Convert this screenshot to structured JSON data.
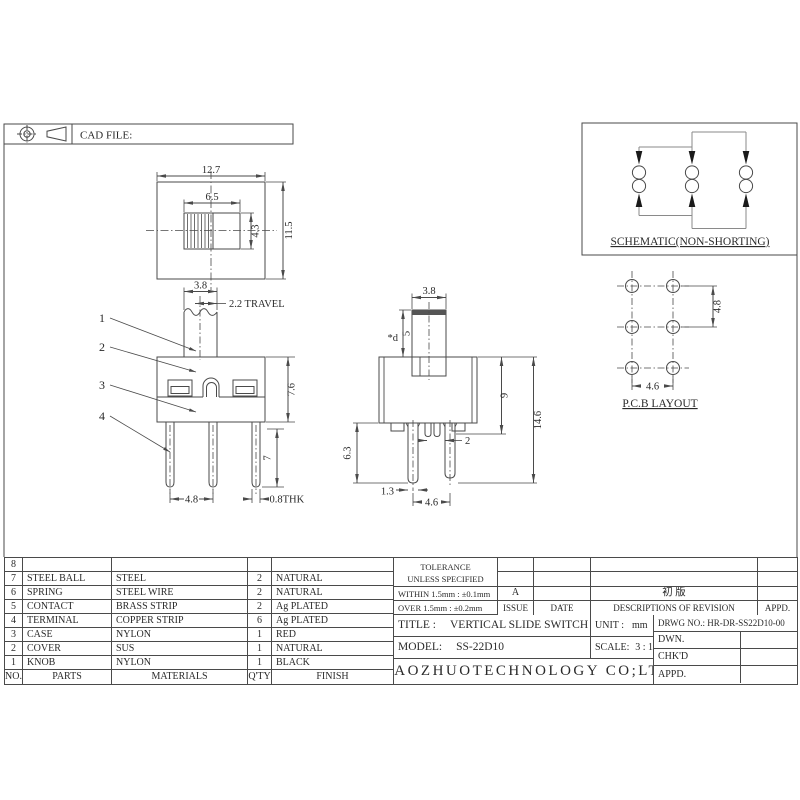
{
  "sheet": {
    "cad_file_label": "CAD FILE:",
    "schematic": {
      "caption": "SCHEMATIC(NON-SHORTING)"
    },
    "pcb": {
      "caption": "P.C.B LAYOUT",
      "pitch_h": "4.6",
      "pitch_v": "4.8"
    },
    "top_view": {
      "width": "12.7",
      "height": "11.5",
      "knob_w": "6.5",
      "knob_h": "4.3"
    },
    "front_view": {
      "knob_w": "3.8",
      "travel": "2.2 TRAVEL",
      "body_h": "7.6",
      "terminal_len": "7",
      "pitch": "4.8",
      "thickness": "0.8THK",
      "callouts": [
        "1",
        "2",
        "3",
        "4"
      ]
    },
    "side_view": {
      "knob_w": "3.8",
      "knob_dia": "*d",
      "knob_h": "5",
      "body_h": "9",
      "total_h": "14.6",
      "leg_len": "6.3",
      "leg_w": "1.3",
      "pitch": "4.6",
      "stub_gap": "2"
    }
  },
  "parts_table": {
    "header": {
      "no": "NO.",
      "parts": "PARTS",
      "materials": "MATERIALS",
      "qty": "Q'TY",
      "finish": "FINISH"
    },
    "rows": [
      {
        "no": "8",
        "parts": "",
        "materials": "",
        "qty": "",
        "finish": ""
      },
      {
        "no": "7",
        "parts": "STEEL BALL",
        "materials": "STEEL",
        "qty": "2",
        "finish": "NATURAL"
      },
      {
        "no": "6",
        "parts": "SPRING",
        "materials": "STEEL WIRE",
        "qty": "2",
        "finish": "NATURAL"
      },
      {
        "no": "5",
        "parts": "CONTACT",
        "materials": "BRASS STRIP",
        "qty": "2",
        "finish": "Ag PLATED"
      },
      {
        "no": "4",
        "parts": "TERMINAL",
        "materials": "COPPER STRIP",
        "qty": "6",
        "finish": "Ag PLATED"
      },
      {
        "no": "3",
        "parts": "CASE",
        "materials": "NYLON",
        "qty": "1",
        "finish": "RED"
      },
      {
        "no": "2",
        "parts": "COVER",
        "materials": "SUS",
        "qty": "1",
        "finish": "NATURAL"
      },
      {
        "no": "1",
        "parts": "KNOB",
        "materials": "NYLON",
        "qty": "1",
        "finish": "BLACK"
      }
    ]
  },
  "tolerance": {
    "title": "TOLERANCE",
    "subtitle": "UNLESS  SPECIFIED",
    "within": "WITHIN 1.5mm : ±0.1mm",
    "over": "OVER 1.5mm : ±0.2mm"
  },
  "revision": {
    "header": {
      "issue": "ISSUE",
      "date": "DATE",
      "desc": "DESCRIPTIONS OF REVISION",
      "appd": "APPD."
    },
    "row": {
      "issue": "A",
      "date": "",
      "desc": "初 版",
      "appd": ""
    }
  },
  "title_block": {
    "title_label": "TITLE :",
    "title": "VERTICAL SLIDE SWITCH",
    "unit_label": "UNIT :",
    "unit": "mm",
    "drwg_no": "DRWG NO.: HR-DR-SS22D10-00",
    "model_label": "MODEL:",
    "model": "SS-22D10",
    "scale_label": "SCALE:",
    "scale": "3 : 1",
    "dwn": "DWN.",
    "chkd": "CHK'D",
    "appd": "APPD.",
    "company": "XIAOZHUOTECHNOLOGY  CO;LTD"
  }
}
